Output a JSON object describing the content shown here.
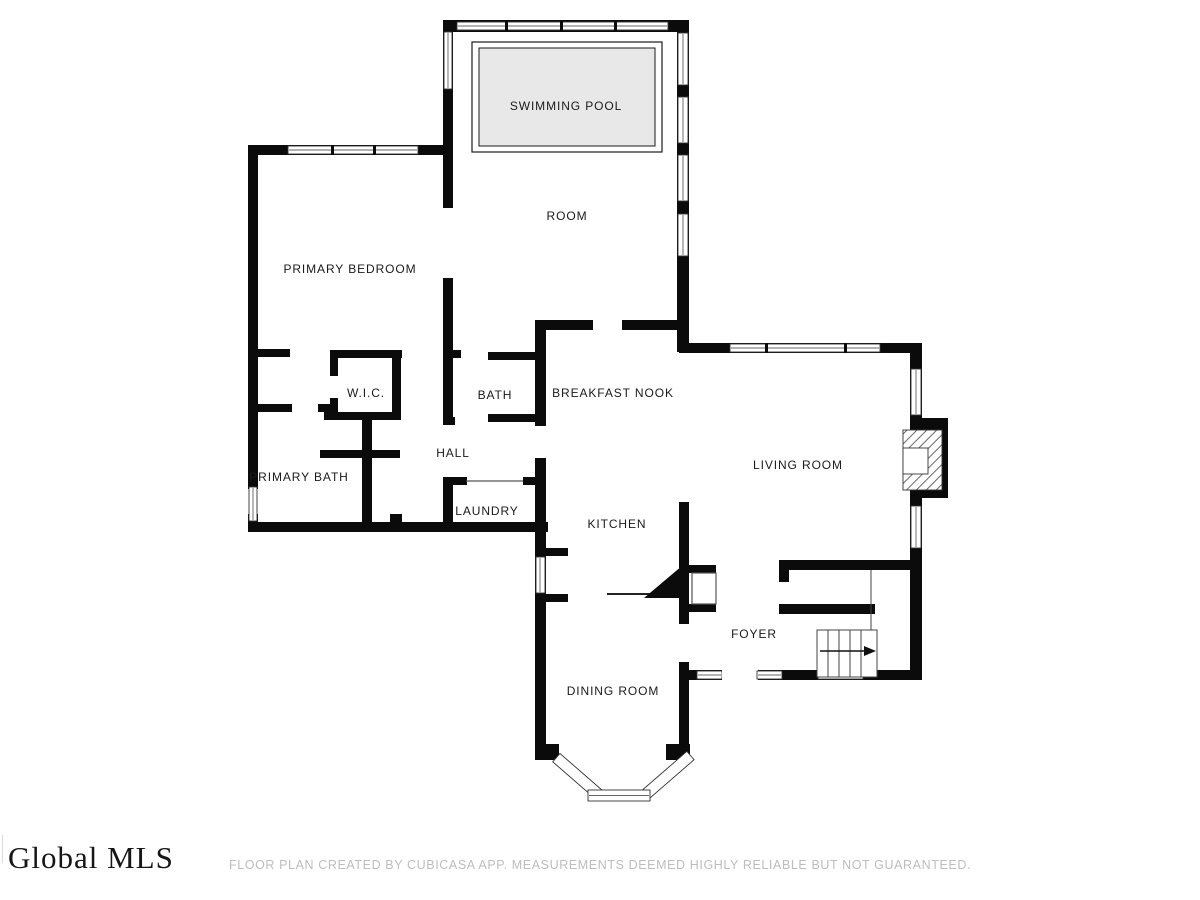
{
  "floorplan": {
    "rooms": [
      {
        "id": "swimming-pool",
        "label": "SWIMMING POOL",
        "x": 566,
        "y": 110
      },
      {
        "id": "pool-room",
        "label": "ROOM",
        "x": 567,
        "y": 220
      },
      {
        "id": "primary-bedroom",
        "label": "PRIMARY BEDROOM",
        "x": 350,
        "y": 273
      },
      {
        "id": "wic",
        "label": "W.I.C.",
        "x": 366,
        "y": 397
      },
      {
        "id": "bath",
        "label": "BATH",
        "x": 495,
        "y": 399
      },
      {
        "id": "breakfast-nook",
        "label": "BREAKFAST NOOK",
        "x": 613,
        "y": 397
      },
      {
        "id": "hall",
        "label": "HALL",
        "x": 453,
        "y": 457
      },
      {
        "id": "primary-bath",
        "label": "PRIMARY BATH",
        "x": 299,
        "y": 481
      },
      {
        "id": "laundry",
        "label": "LAUNDRY",
        "x": 487,
        "y": 515
      },
      {
        "id": "kitchen",
        "label": "KITCHEN",
        "x": 617,
        "y": 528
      },
      {
        "id": "living-room",
        "label": "LIVING ROOM",
        "x": 798,
        "y": 469
      },
      {
        "id": "foyer",
        "label": "FOYER",
        "x": 754,
        "y": 638
      },
      {
        "id": "dining-room",
        "label": "DINING ROOM",
        "x": 613,
        "y": 695
      }
    ],
    "icons": [
      "pool-icon",
      "fireplace-icon",
      "staircase-icon",
      "bay-window-icon",
      "kitchen-counter-icon"
    ]
  },
  "footer": {
    "logo_text": "Global MLS",
    "disclaimer": "FLOOR PLAN CREATED BY CUBICASA APP. MEASUREMENTS DEEMED HIGHLY RELIABLE BUT NOT GUARANTEED."
  },
  "colors": {
    "wall": "#0b0b0b",
    "pool_fill": "#e8e8e8",
    "label_text": "#1a1a1a",
    "logo_text": "#161616",
    "disclaimer_text": "#bdbdbd",
    "window_stroke": "#333333"
  }
}
